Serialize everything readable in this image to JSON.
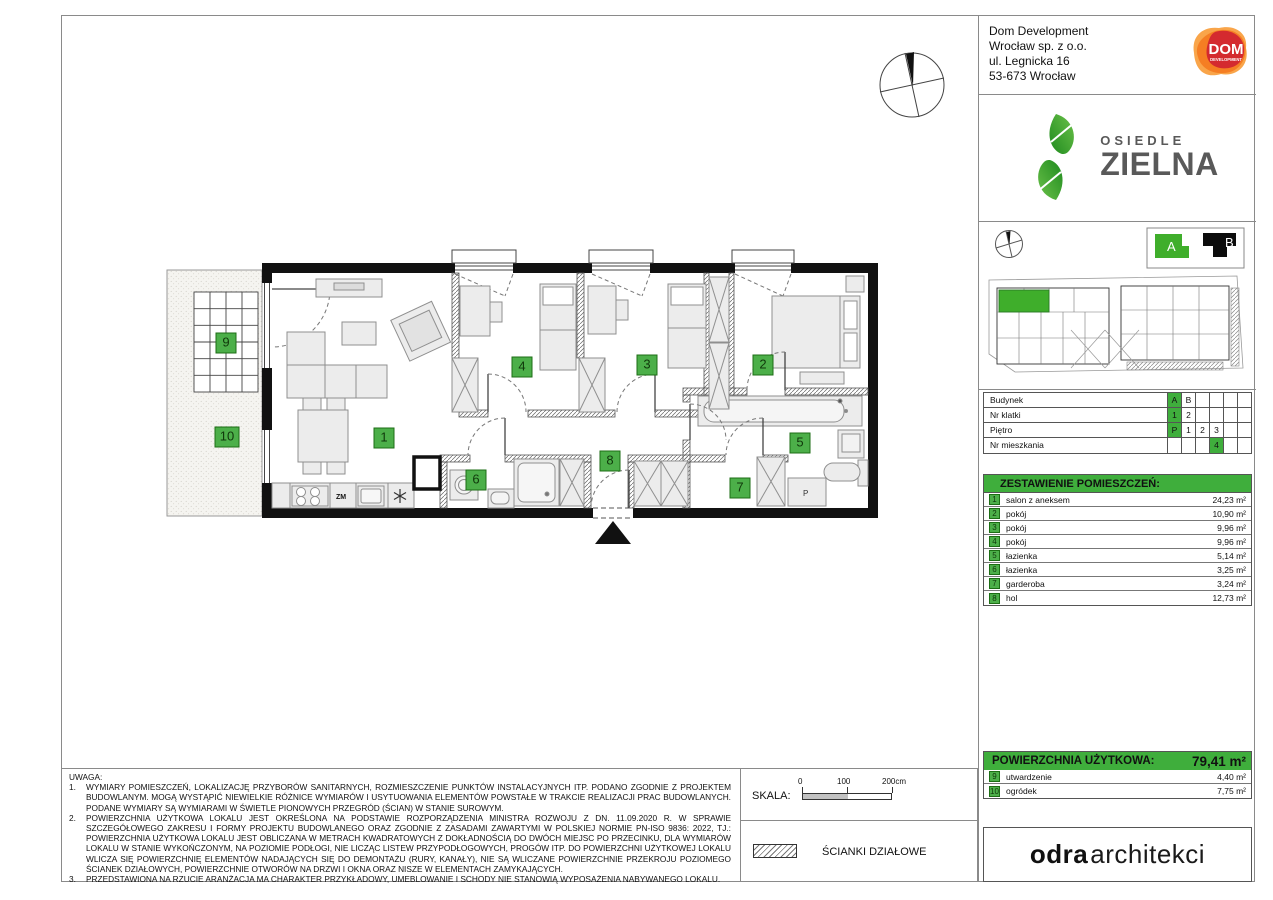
{
  "company": {
    "lines": [
      "Dom Development",
      "Wrocław sp. z o.o.",
      "ul. Legnicka 16",
      "53-673 Wrocław"
    ]
  },
  "brand": {
    "dom": "DOM",
    "dom_sub": "DEVELOPMENT",
    "estate_top": "OSIEDLE",
    "estate_bottom": "ZIELNA"
  },
  "site": {
    "legend_a": "A",
    "legend_b": "B"
  },
  "unit_table": {
    "rows": [
      {
        "label": "Budynek",
        "cells": [
          "A",
          "B",
          "",
          "",
          "",
          ""
        ]
      },
      {
        "label": "Nr klatki",
        "cells": [
          "1",
          "2",
          "",
          "",
          "",
          ""
        ]
      },
      {
        "label": "Piętro",
        "cells": [
          "P",
          "1",
          "2",
          "3",
          "",
          ""
        ]
      },
      {
        "label": "Nr mieszkania",
        "cells": [
          "",
          "",
          "",
          "4",
          "",
          ""
        ]
      }
    ]
  },
  "rooms": {
    "header": "ZESTAWIENIE POMIESZCZEŃ:",
    "items": [
      {
        "no": "1",
        "name": "salon z aneksem",
        "area": "24,23 m²"
      },
      {
        "no": "2",
        "name": "pokój",
        "area": "10,90 m²"
      },
      {
        "no": "3",
        "name": "pokój",
        "area": "9,96 m²"
      },
      {
        "no": "4",
        "name": "pokój",
        "area": "9,96 m²"
      },
      {
        "no": "5",
        "name": "łazienka",
        "area": "5,14 m²"
      },
      {
        "no": "6",
        "name": "łazienka",
        "area": "3,25 m²"
      },
      {
        "no": "7",
        "name": "garderoba",
        "area": "3,24 m²"
      },
      {
        "no": "8",
        "name": "hol",
        "area": "12,73 m²"
      }
    ]
  },
  "usable": {
    "label": "POWIERZCHNIA UŻYTKOWA:",
    "value": "79,41 m²"
  },
  "outdoor": {
    "items": [
      {
        "no": "9",
        "name": "utwardzenie",
        "area": "4,40 m²"
      },
      {
        "no": "10",
        "name": "ogródek",
        "area": "7,75 m²"
      }
    ]
  },
  "notes": {
    "title": "UWAGA:",
    "items": [
      {
        "n": "1.",
        "text": "WYMIARY POMIESZCZEŃ, LOKALIZACJĘ PRZYBORÓW SANITARNYCH, ROZMIESZCZENIE PUNKTÓW INSTALACYJNYCH ITP. PODANO ZGODNIE Z PROJEKTEM BUDOWLANYM. MOGĄ WYSTĄPIĆ NIEWIELKIE RÓŻNICE WYMIARÓW I USYTUOWANIA ELEMENTÓW POWSTAŁE W TRAKCIE REALIZACJI PRAC BUDOWLANYCH. PODANE WYMIARY SĄ WYMIARAMI W ŚWIETLE PIONOWYCH PRZEGRÓD (ŚCIAN) W STANIE SUROWYM."
      },
      {
        "n": "2.",
        "text": "POWIERZCHNIA UŻYTKOWA LOKALU JEST OKREŚLONA NA PODSTAWIE ROZPORZĄDZENIA MINISTRA ROZWOJU Z DN. 11.09.2020 R. W SPRAWIE SZCZEGÓŁOWEGO ZAKRESU I FORMY PROJEKTU BUDOWLANEGO ORAZ ZGODNIE Z ZASADAMI ZAWARTYMI W POLSKIEJ NORMIE PN-ISO 9836: 2022, TJ.: POWIERZCHNIA UŻYTKOWA LOKALU JEST OBLICZANA W METRACH KWADRATOWYCH Z DOKŁADNOŚCIĄ DO DWÓCH MIEJSC PO PRZECINKU, DLA WYMIARÓW LOKALU W STANIE WYKOŃCZONYM, NA POZIOMIE PODŁOGI, NIE LICZĄC LISTEW PRZYPODŁOGOWYCH, PROGÓW ITP. DO POWIERZCHNI UŻYTKOWEJ LOKALU WLICZA SIĘ POWIERZCHNIĘ ELEMENTÓW NADAJĄCYCH SIĘ DO DEMONTAŻU (RURY, KANAŁY), NIE SĄ WLICZANE POWIERZCHNIE PRZEKROJU POZIOMEGO ŚCIANEK DZIAŁOWYCH, POWIERZCHNIE OTWORÓW NA DRZWI I OKNA ORAZ NISZE W ELEMENTACH ZAMYKAJĄCYCH."
      },
      {
        "n": "3.",
        "text": "PRZEDSTAWIONA NA RZUCIE ARANŻACJA MA CHARAKTER PRZYKŁADOWY, UMEBLOWANIE I SCHODY NIE STANOWIĄ WYPOSAŻENIA NABYWANEGO LOKALU."
      }
    ]
  },
  "scale": {
    "label": "SKALA:",
    "ticks": [
      "0",
      "100",
      "200cm"
    ]
  },
  "partition_legend": {
    "label": "ŚCIANKI DZIAŁOWE"
  },
  "architect": {
    "bold": "odra",
    "light": "architekci"
  },
  "plan": {
    "labels": {
      "zm": "ZM",
      "p": "P"
    },
    "badges": [
      {
        "n": "1",
        "x": 384,
        "y": 438
      },
      {
        "n": "2",
        "x": 763,
        "y": 365
      },
      {
        "n": "3",
        "x": 647,
        "y": 365
      },
      {
        "n": "4",
        "x": 522,
        "y": 367
      },
      {
        "n": "5",
        "x": 800,
        "y": 443
      },
      {
        "n": "6",
        "x": 476,
        "y": 480
      },
      {
        "n": "7",
        "x": 740,
        "y": 488
      },
      {
        "n": "8",
        "x": 610,
        "y": 461
      },
      {
        "n": "9",
        "x": 226,
        "y": 343
      },
      {
        "n": "10",
        "x": 227,
        "y": 437,
        "wide": true
      }
    ]
  },
  "colors": {
    "accent_green": "#3fae3c",
    "badge_green": "#4caf49",
    "wall_black": "#111111",
    "dom_orange": "#f47b20",
    "dom_red": "#d22630",
    "leaf_green": "#2f9e33"
  }
}
